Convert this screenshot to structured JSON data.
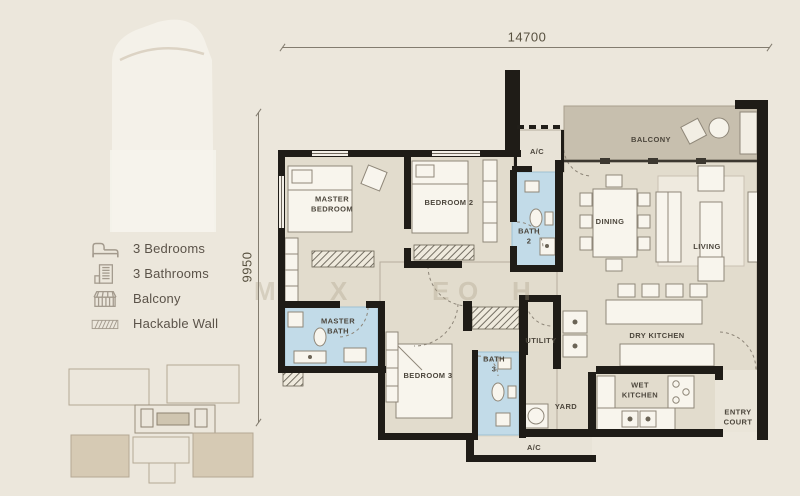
{
  "legend": {
    "items": [
      {
        "icon": "bed-icon",
        "label": "3 Bedrooms"
      },
      {
        "icon": "bathroom-icon",
        "label": "3 Bathrooms"
      },
      {
        "icon": "balcony-icon",
        "label": "Balcony"
      },
      {
        "icon": "hackable-wall-icon",
        "label": "Hackable Wall"
      }
    ]
  },
  "dimensions": {
    "width": "14700",
    "height": "9950"
  },
  "rooms": {
    "master_bedroom": "MASTER BEDROOM",
    "bedroom_2": "BEDROOM 2",
    "bath_2": "BATH 2",
    "ac_top": "A/C",
    "balcony": "BALCONY",
    "dining": "DINING",
    "living": "LIVING",
    "master_bath": "MASTER BATH",
    "bedroom_3": "BEDROOM 3",
    "bath_3": "BATH 3",
    "utility": "UTILITY",
    "dry_kitchen": "DRY KITCHEN",
    "wet_kitchen": "WET KITCHEN",
    "yard": "YARD",
    "entry_court": "ENTRY COURT",
    "ac_bottom": "A/C"
  },
  "watermark": {
    "letters": [
      "M",
      "X",
      "E",
      "O",
      "H"
    ]
  },
  "colors": {
    "background": "#ece7dc",
    "wall": "#1f1c17",
    "room_fill": "#e2dccd",
    "balcony_fill": "#c7bfae",
    "bath_fill": "#c2dbe8",
    "keyplan_highlight": "#d6cab4"
  }
}
